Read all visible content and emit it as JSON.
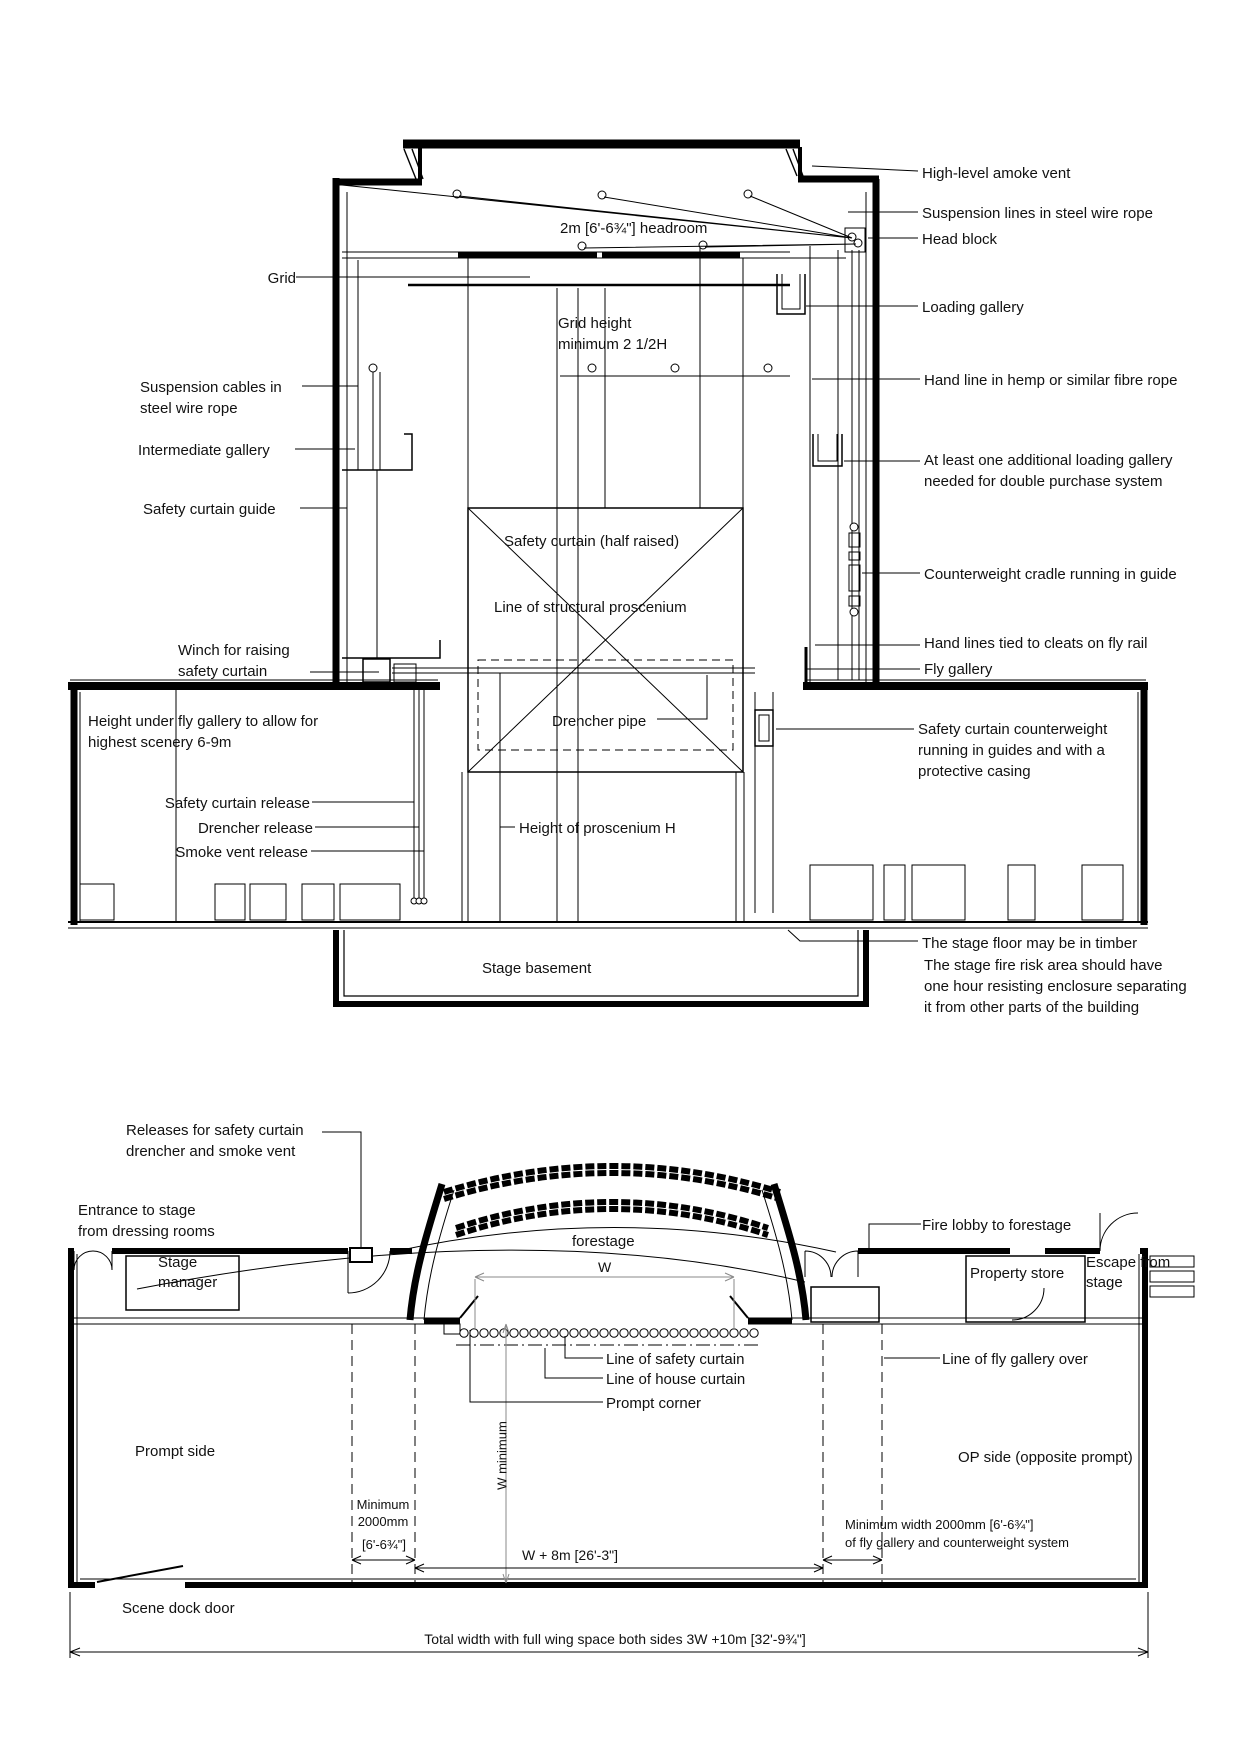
{
  "colors": {
    "line": "#000000",
    "background": "#ffffff",
    "dimension": "#8a8a8a"
  },
  "section": {
    "left": {
      "grid": "Grid",
      "suspension_cables": [
        "Suspension cables in",
        "steel wire rope"
      ],
      "intermediate_gallery": "Intermediate gallery",
      "safety_curtain_guide": "Safety curtain guide",
      "winch": [
        "Winch for raising",
        "safety curtain"
      ],
      "height_under_fly": [
        "Height under fly gallery to allow for",
        "highest scenery 6-9m"
      ],
      "safety_curtain_release": "Safety curtain release",
      "drencher_release": "Drencher release",
      "smoke_vent_release": "Smoke vent release"
    },
    "center": {
      "headroom": "2m [6'-6¾\"] headroom",
      "grid_height": [
        "Grid height",
        "minimum 2 1/2H"
      ],
      "safety_curtain": "Safety curtain (half raised)",
      "structural_proscenium": "Line of structural proscenium",
      "drencher_pipe": "Drencher pipe",
      "proscenium_height": "Height of proscenium H",
      "stage_basement": "Stage basement"
    },
    "right": {
      "smoke_vent": "High-level amoke vent",
      "suspension_lines": "Suspension lines in steel wire rope",
      "head_block": "Head block",
      "loading_gallery": "Loading gallery",
      "hand_line": "Hand line in hemp or similar fibre rope",
      "additional_gallery": [
        "At least one additional loading gallery",
        "needed for double purchase system"
      ],
      "counterweight_cradle": "Counterweight cradle running in guide",
      "hand_lines_cleats": "Hand lines tied to cleats on fly rail",
      "fly_gallery": "Fly gallery",
      "sc_counterweight": [
        "Safety curtain counterweight",
        "running in guides and with a",
        "protective casing"
      ],
      "timber_floor": "The stage floor may be in timber",
      "fire_risk": [
        "The stage fire risk area should have",
        "one hour resisting enclosure separating",
        "it from other parts of the building"
      ]
    }
  },
  "plan": {
    "releases": [
      "Releases for safety curtain",
      "drencher and smoke vent"
    ],
    "entrance": [
      "Entrance to stage",
      "from dressing rooms"
    ],
    "stage_manager": [
      "Stage",
      "manager"
    ],
    "forestage": "forestage",
    "w": "W",
    "fire_lobby": "Fire lobby to forestage",
    "property_store": "Property store",
    "escape": [
      "Escape from",
      "stage"
    ],
    "line_safety_curtain": "Line of safety curtain",
    "line_house_curtain": "Line of house curtain",
    "prompt_corner": "Prompt corner",
    "line_fly_gallery": "Line of fly gallery over",
    "prompt_side": "Prompt side",
    "op_side": "OP side (opposite prompt)",
    "w_minimum": "W minimum",
    "min_2000": [
      "Minimum",
      "2000mm",
      "[6'-6¾\"]"
    ],
    "w_plus_8m": "W + 8m [26'-3\"]",
    "min_width_fly": [
      "Minimum width 2000mm [6'-6¾\"]",
      "of fly gallery and counterweight system"
    ],
    "scene_dock": "Scene dock door",
    "total_width": "Total width with full wing space both sides 3W +10m [32'-9¾\"]"
  }
}
